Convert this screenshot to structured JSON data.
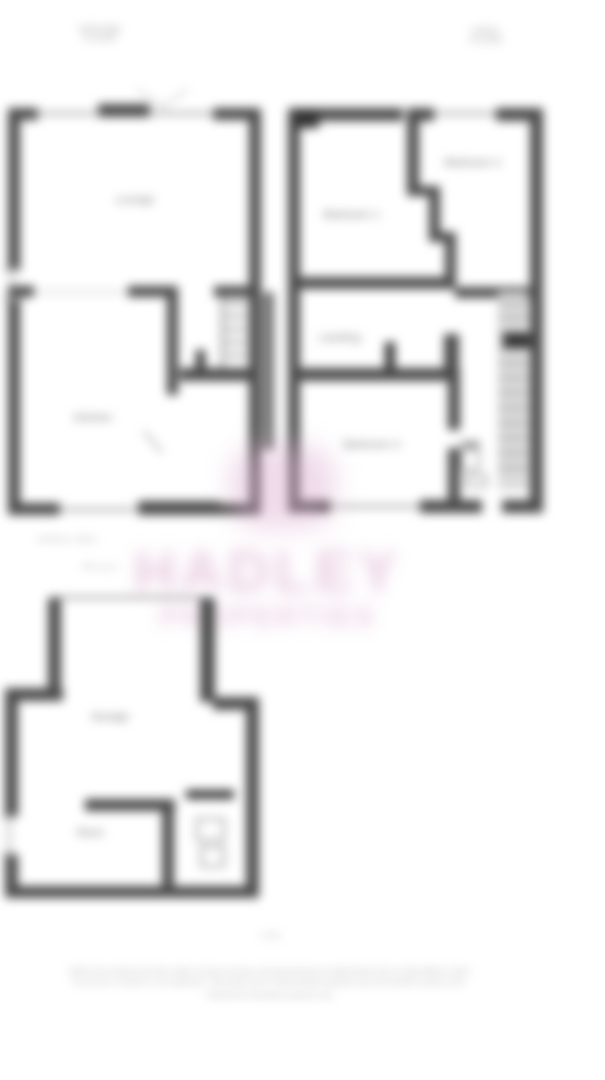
{
  "floors": {
    "ground": {
      "title_line1": "GROUND",
      "title_line2": "FLOOR",
      "rooms": {
        "lounge": "Lounge",
        "kitchen": "Kitchen"
      },
      "area_note_line1": "APPROX. AREA",
      "area_note_line2": "89.5 sq m"
    },
    "first": {
      "title_line1": "FIRST",
      "title_line2": "FLOOR",
      "rooms": {
        "bedroom1": "Bedroom 1",
        "bedroom2": "Bedroom 2",
        "landing": "Landing",
        "bedroom3": "Bedroom 3"
      }
    },
    "outbuilding": {
      "rooms": {
        "garage": "Garage",
        "store": "Store"
      }
    }
  },
  "watermark": {
    "line1": "HADLEY",
    "line2": "PROPERTIES",
    "color": "#d9a8cc"
  },
  "footer": {
    "scale_note": "1:100",
    "disclaimer_line1": "Whilst every attempt has been made to ensure accuracy, all measurements are approximate and no responsibility is taken",
    "disclaimer_line2": "for any error, omission or mis-statement. These plans are for representation purposes only and should be used as such.",
    "disclaimer_line3": "Produced for illustration purposes only."
  }
}
